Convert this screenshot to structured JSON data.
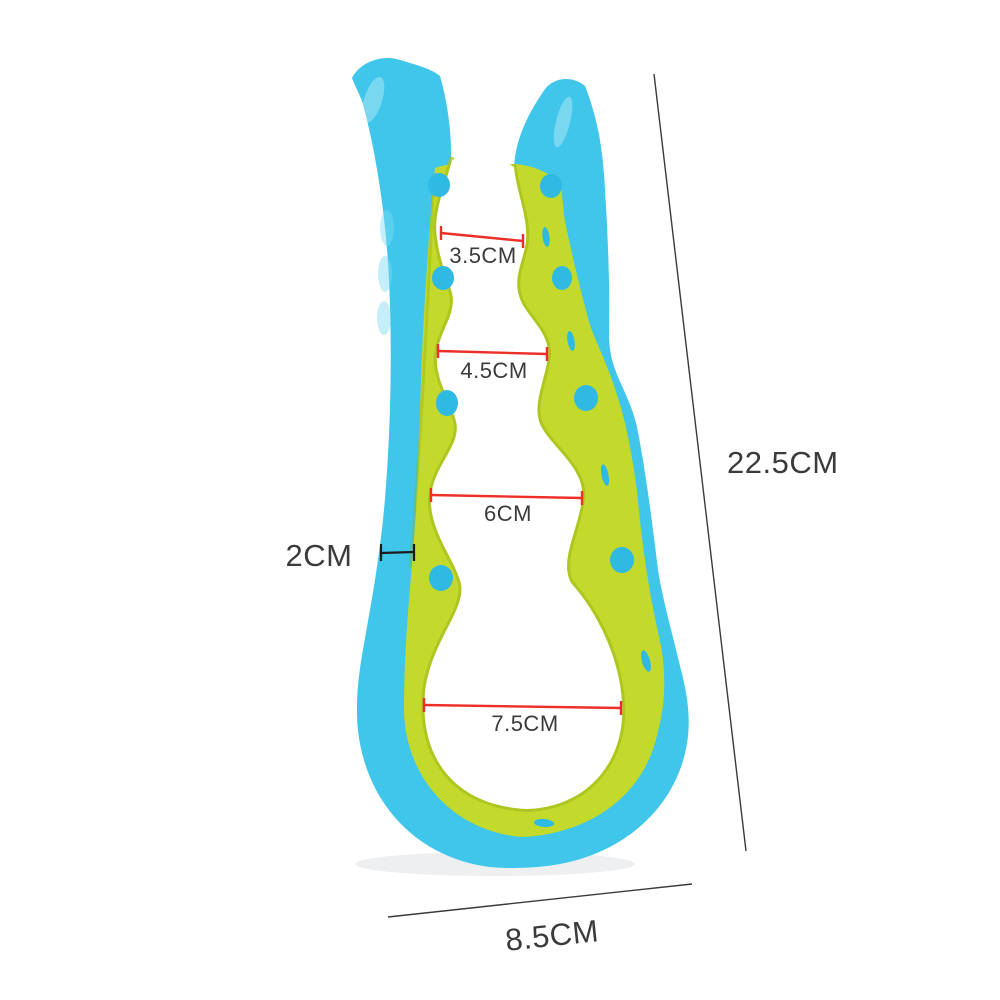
{
  "figure": {
    "description": "Multi-size jar opener product dimension diagram",
    "background": "#ffffff"
  },
  "product": {
    "name": "multi-size-jar-opener",
    "shell_color": "#3fc6ea",
    "liner_color": "#c3d92c",
    "dot_color": "#2fbae3"
  },
  "annotations": {
    "opening_line_color": "#ee2f28",
    "overall_line_color": "#3a3a3a",
    "text_color": "#3b3b3b",
    "openings": [
      {
        "label": "3.5CM"
      },
      {
        "label": "4.5CM"
      },
      {
        "label": "6CM"
      },
      {
        "label": "7.5CM"
      }
    ],
    "thickness": {
      "label": "2CM"
    },
    "overall_height": {
      "label": "22.5CM"
    },
    "overall_width": {
      "label": "8.5CM"
    }
  }
}
